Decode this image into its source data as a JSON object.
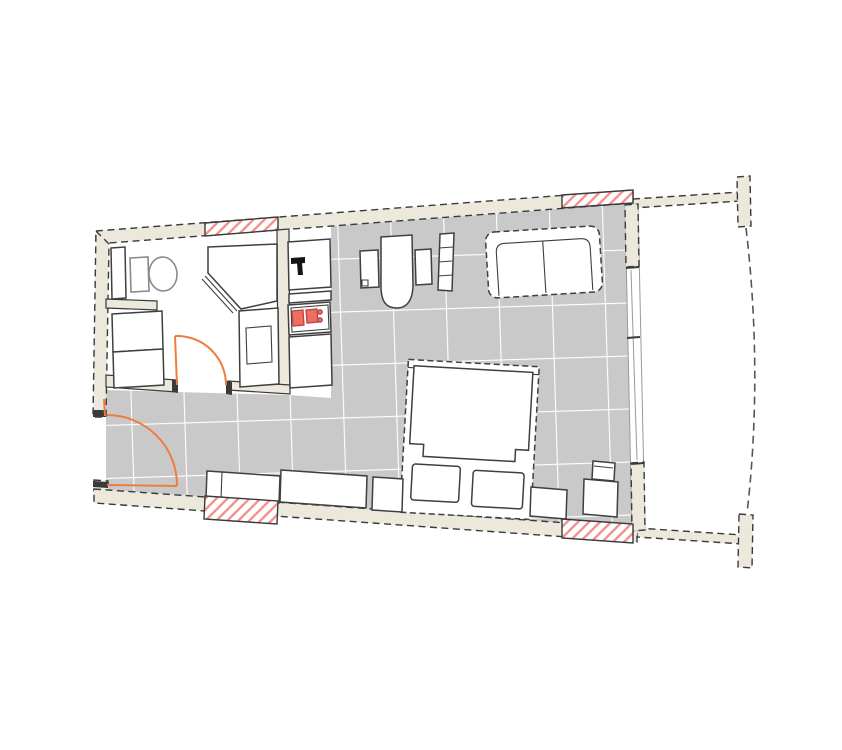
{
  "plan": {
    "type": "studio-apartment-floor-plan",
    "colors": {
      "page_bg": "#ffffff",
      "wall_fill": "#ece8dc",
      "wall_line": "#3a3a3a",
      "cap_dark": "#3a3a3a",
      "floor_tile": "#c9c9c9",
      "tile_grout": "#ffffff",
      "fixture_line": "#3f3f3f",
      "soft_line": "#8a8a8a",
      "glass_line": "#9a9a9a",
      "hatch_bg": "#ffffff",
      "hatch_line": "#f2948d",
      "door_swing": "#ed7d3f",
      "burner_fill": "#ee6e62",
      "burner_line": "#b9463e",
      "faucet": "#141414"
    },
    "labels": {
      "floor": "tiled-floor",
      "toilet": "toilet",
      "radiator": "radiator",
      "washer": "washer-dryer-stack",
      "shower": "corner-shower",
      "vanity": "sink-vanity",
      "kitchen_sink": "kitchen-sink-unit",
      "stove": "two-burner-stove",
      "kitchen_cabinet": "kitchen-cabinet",
      "entry_door": "entry-door-swing",
      "bath_door": "bathroom-door-swing",
      "desk": "desk-with-side-units",
      "chair": "chair",
      "shelf": "wall-shelf",
      "sofa": "two-seat-sofa",
      "bed": "double-bed",
      "bench": "bench",
      "sideboard": "sideboard-row",
      "cabinet": "low-cabinet",
      "nightstand": "nightstand",
      "balcony": "curved-balcony",
      "window": "window-wall"
    }
  }
}
